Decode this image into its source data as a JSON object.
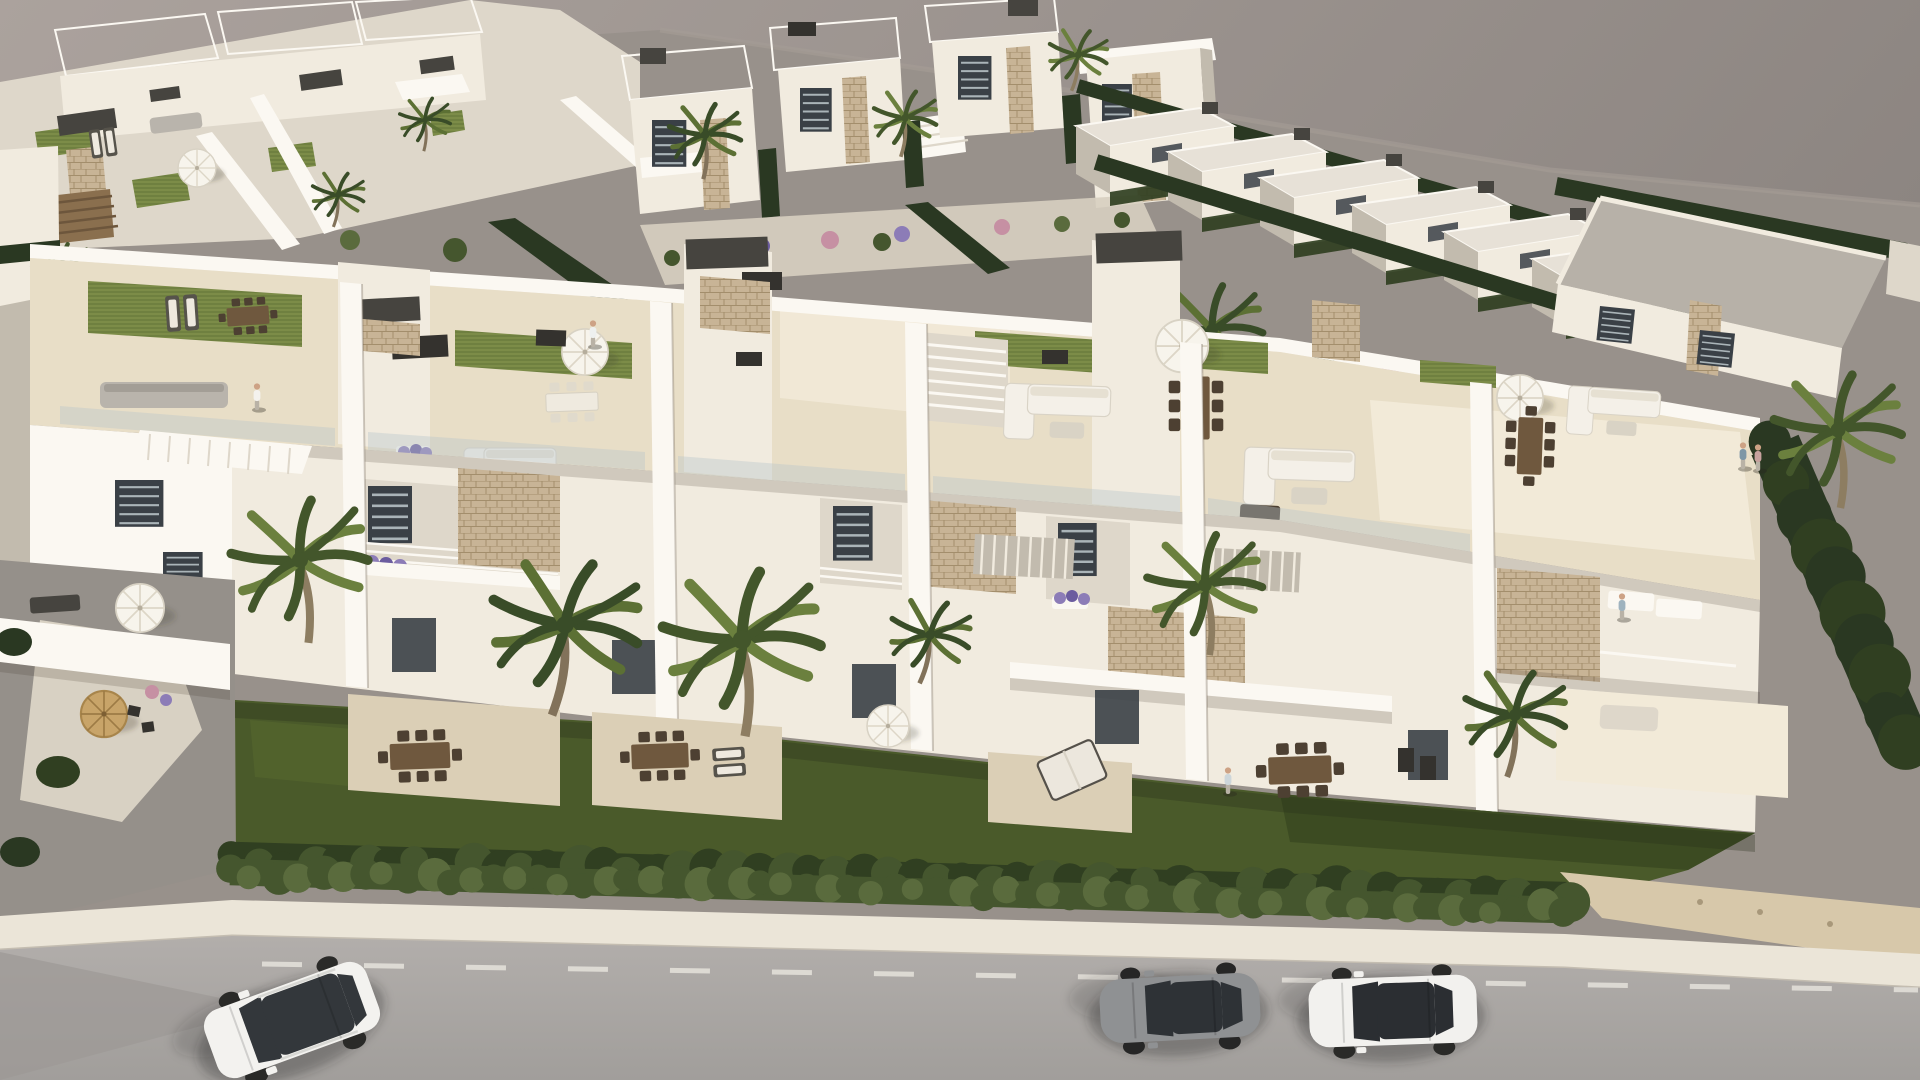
{
  "scene": {
    "type": "3d-architectural-render",
    "view": "aerial-oblique",
    "content": "white residential development with rooftop solariums, gardens, palm trees, hedge, sidewalk and street with three parked cars",
    "visible_text": [],
    "counts": {
      "cars": 3,
      "people": 6,
      "foreground_palms": 6,
      "background_palms": 8
    }
  },
  "palette": {
    "sky1": "#a9a19c",
    "sky2": "#8a837f",
    "ground": "#98918b",
    "groundline": "#a59d96",
    "white0": "#fbf8f2",
    "white1": "#f1ebdf",
    "white2": "#ded7ca",
    "white3": "#c2bbae",
    "white4": "#a59e91",
    "bgroof": "#e7e1d7",
    "roofgray": "#b7b1a8",
    "tile1": "#e8dec7",
    "tile2": "#dbcfb6",
    "tile3": "#f2ead8",
    "turf1": "#87974f",
    "turf2": "#6f8040",
    "lawn1": "#4a5a2a",
    "lawn2": "#394921",
    "hedge1": "#5a6b3d",
    "hedge2": "#45562e",
    "hedge3": "#303f21",
    "cyp": "#2a3822",
    "stone1": "#c8b496",
    "stone2": "#9a8462",
    "dark1": "#46443f",
    "dark2": "#34322e",
    "wood": "#6f583e",
    "woodD": "#4d4032",
    "glass": "#3a4046",
    "road1": "#adaaa6",
    "road2": "#9c9995",
    "walk": "#ebe5d8",
    "drive": "#d8d1c3",
    "gravel": "#95908a",
    "sand": "#d7c8aa",
    "purple": "#8c7cb7",
    "purpleD": "#6b5c9f",
    "pink": "#c690a3",
    "skin": "#cda285",
    "trunk": "#8d7d61"
  },
  "palm_variants": [
    {
      "f1": "#6b803e",
      "f2": "#43562b",
      "t": "#8d7d61"
    },
    {
      "f1": "#5c7034",
      "f2": "#394c28",
      "t": "#82725a"
    }
  ],
  "palms": [
    {
      "x": 300,
      "y": 560,
      "s": 1.6,
      "rot": -8,
      "v": 0,
      "layer": "fg"
    },
    {
      "x": 565,
      "y": 625,
      "s": 1.75,
      "rot": 6,
      "v": 1,
      "layer": "fg"
    },
    {
      "x": 742,
      "y": 640,
      "s": 1.85,
      "rot": -4,
      "v": 0,
      "layer": "fg"
    },
    {
      "x": 930,
      "y": 635,
      "s": 0.95,
      "rot": 10,
      "v": 1,
      "layer": "fg"
    },
    {
      "x": 1205,
      "y": 585,
      "s": 1.35,
      "rot": -6,
      "v": 0,
      "layer": "fg"
    },
    {
      "x": 1515,
      "y": 715,
      "s": 1.2,
      "rot": 5,
      "v": 1,
      "layer": "fg"
    },
    {
      "x": 705,
      "y": 135,
      "s": 0.85,
      "rot": 0,
      "v": 1,
      "layer": "bg"
    },
    {
      "x": 1078,
      "y": 55,
      "s": 0.7,
      "rot": 8,
      "v": 0,
      "layer": "bg"
    },
    {
      "x": 1212,
      "y": 330,
      "s": 1.2,
      "rot": -5,
      "v": 1,
      "layer": "bg"
    },
    {
      "x": 905,
      "y": 118,
      "s": 0.75,
      "rot": 4,
      "v": 0,
      "layer": "bg"
    },
    {
      "x": 425,
      "y": 120,
      "s": 0.6,
      "rot": 0,
      "v": 1,
      "layer": "bg"
    },
    {
      "x": 62,
      "y": 270,
      "s": 0.7,
      "rot": -6,
      "v": 0,
      "layer": "bg"
    },
    {
      "x": 338,
      "y": 195,
      "s": 0.62,
      "rot": 6,
      "v": 1,
      "layer": "bg"
    },
    {
      "x": 1838,
      "y": 430,
      "s": 1.5,
      "rot": -4,
      "v": 0,
      "layer": "fg"
    }
  ],
  "people": [
    {
      "x": 257,
      "y": 396,
      "c": "#f4f2ee"
    },
    {
      "x": 593,
      "y": 333,
      "c": "#eef0ef"
    },
    {
      "x": 1228,
      "y": 780,
      "c": "#cdd6da"
    },
    {
      "x": 1622,
      "y": 606,
      "c": "#9fb3bf"
    },
    {
      "x": 1743,
      "y": 455,
      "c": "#7e97a6"
    },
    {
      "x": 1758,
      "y": 457,
      "c": "#c7a29e"
    }
  ],
  "hedges": [
    {
      "target": "hedge-back",
      "x1": 236,
      "y1": 858,
      "x2": 1566,
      "y2": 898,
      "step": 26,
      "r": 17,
      "colors": [
        "#303f21",
        "#45562e"
      ]
    },
    {
      "target": "hedge-front",
      "x1": 230,
      "y1": 872,
      "x2": 1562,
      "y2": 910,
      "step": 22,
      "r": 14,
      "colors": [
        "#45562e",
        "#5a6b3d"
      ]
    },
    {
      "target": "right-screen",
      "x1": 1775,
      "y1": 445,
      "x2": 1905,
      "y2": 745,
      "step": 34,
      "r": 27,
      "colors": [
        "#2a3822",
        "#303f21"
      ]
    }
  ],
  "background_right_row": {
    "items": [
      {
        "x": 1082,
        "y": 96
      },
      {
        "x": 1174,
        "y": 122
      },
      {
        "x": 1266,
        "y": 148
      },
      {
        "x": 1358,
        "y": 175
      },
      {
        "x": 1450,
        "y": 202
      },
      {
        "x": 1538,
        "y": 229
      }
    ]
  },
  "cars": [
    {
      "kind": "suv",
      "name": "white-suv",
      "x": 292,
      "y": 1020,
      "rot": -20,
      "body": "#f3f2ef",
      "glass": "#33373b",
      "accent": "#d8d8d4"
    },
    {
      "kind": "coupe",
      "name": "gray-coupe",
      "x": 1180,
      "y": 1008,
      "rot": -3,
      "body": "#8f9193",
      "glass": "#2e3236",
      "accent": "#717376"
    },
    {
      "kind": "sedan",
      "name": "white-sedan",
      "x": 1393,
      "y": 1011,
      "rot": -2,
      "body": "#f2f1ee",
      "glass": "#2b2e32",
      "accent": "#dddcd8"
    }
  ],
  "road_dash": {
    "x1": 262,
    "y1": 964,
    "x2": 1918,
    "y2": 990,
    "width": 5,
    "dash": "40 62",
    "color": "#e9e6df",
    "opacity": 0.8
  }
}
